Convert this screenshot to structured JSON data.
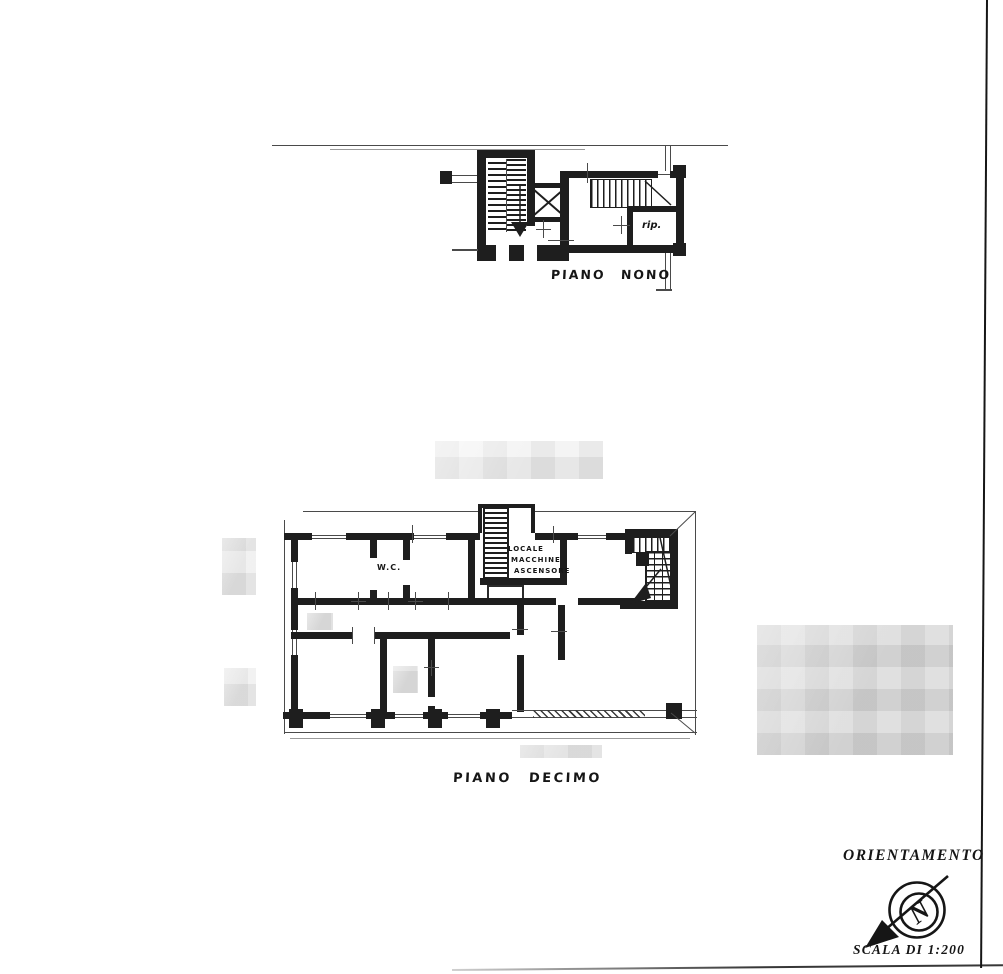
{
  "colors": {
    "paper": "#ffffff",
    "ink": "#1e1e1e",
    "thin_line": "#4a4a4a",
    "redaction_light": "#f0f0f0",
    "redaction_dark": "#d9d9d9"
  },
  "plans": {
    "nono": {
      "title": "PIANO NONO",
      "rooms": {
        "storage": "rip."
      }
    },
    "decimo": {
      "title": "PIANO DECIMO",
      "rooms": {
        "wc": "W.C.",
        "machine": [
          "LOCALE",
          "MACCHINE",
          "ASCENSORE"
        ]
      }
    }
  },
  "legend": {
    "orientation": "ORIENTAMENTO",
    "scale": "SCALA DI 1:200",
    "compass_letter": "N"
  }
}
